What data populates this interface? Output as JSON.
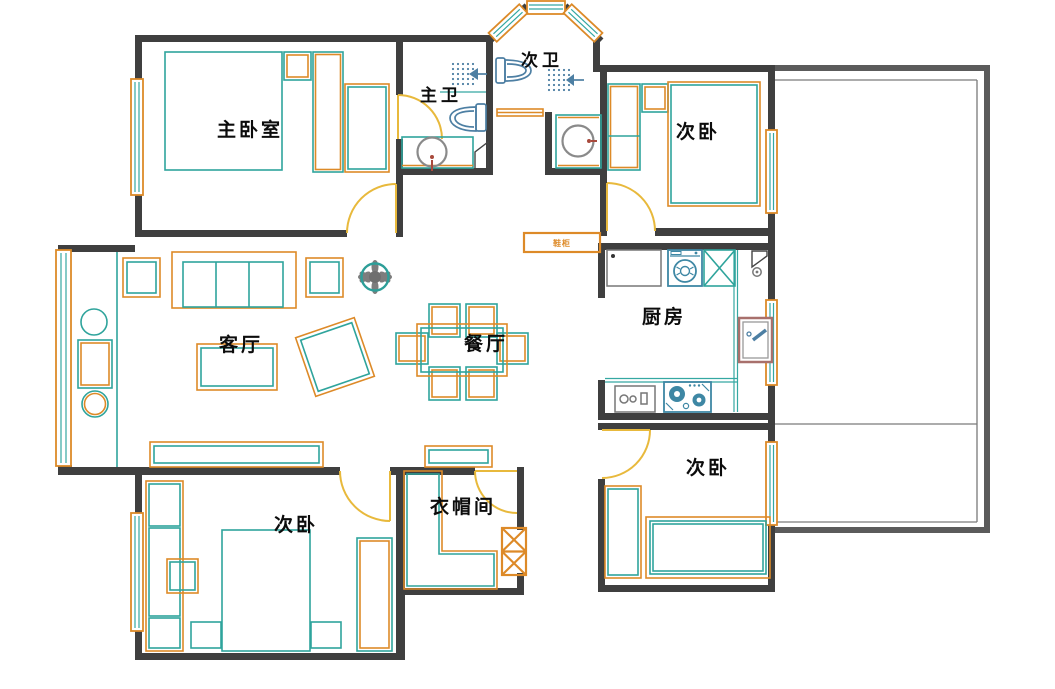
{
  "rooms": {
    "master_bedroom": "主卧室",
    "master_bathroom": "主卫",
    "second_bathroom": "次卫",
    "bedroom_northeast": "次卧",
    "kitchen": "厨房",
    "living_room": "客厅",
    "dining_room": "餐厅",
    "bedroom_southwest": "次卧",
    "cloakroom": "衣帽间",
    "bedroom_southeast": "次卧",
    "shoe_cabinet": "鞋柜"
  },
  "colors": {
    "wall": "#3f3f3f",
    "balcony_wall": "#5b5b5b",
    "window_frame": "#dc8a28",
    "window_glass": "#35a8a2",
    "door": "#e8b93c",
    "furniture_primary": "#2fa49c",
    "furniture_accent": "#dd8a28",
    "bath_fixture": "#4d7fa3",
    "faucet": "#a8493c",
    "basin": "#8a8a8a",
    "plant_leaves": "#7d7d7d"
  }
}
